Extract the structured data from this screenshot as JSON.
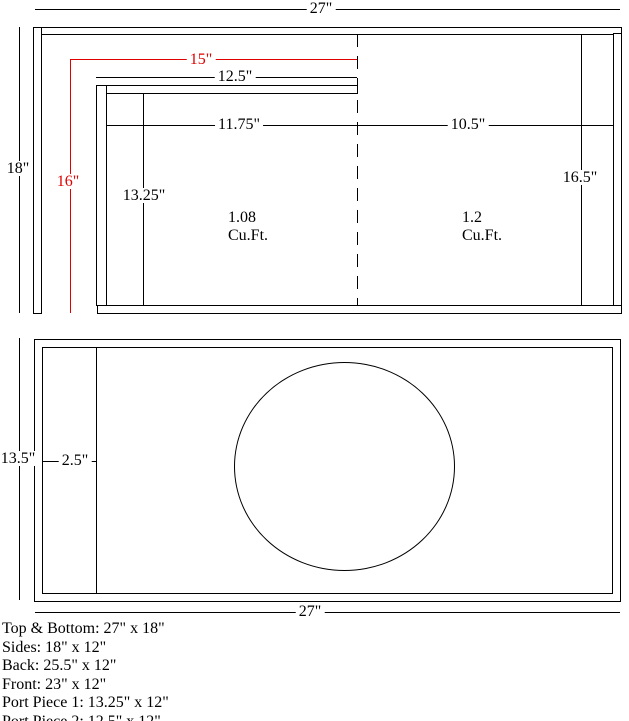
{
  "colors": {
    "background": "#ffffff",
    "line": "#000000",
    "dimension_red": "#e00000"
  },
  "top_view": {
    "overall_width": "27\"",
    "side_height": "18\"",
    "port_length_red": "15\"",
    "port_depth_red": "16\"",
    "port_piece_2_length": "12.5\"",
    "left_chamber_width": "11.75\"",
    "right_chamber_width": "10.5\"",
    "port_piece_1_length": "13.25\"",
    "right_chamber_depth": "16.5\"",
    "left_chamber_volume_value": "1.08",
    "left_chamber_volume_unit": "Cu.Ft.",
    "right_chamber_volume_value": "1.2",
    "right_chamber_volume_unit": "Cu.Ft."
  },
  "front_view": {
    "panel_height": "13.5\"",
    "port_opening_width": "2.5\"",
    "overall_width": "27\""
  },
  "cut_list": {
    "items": [
      "Top & Bottom: 27\" x 18\"",
      "Sides: 18\" x 12\"",
      "Back: 25.5\" x 12\"",
      "Front: 23\" x 12\"",
      "Port Piece 1: 13.25\" x 12\"",
      "Port Piece 2: 12.5\" x 12\""
    ]
  }
}
